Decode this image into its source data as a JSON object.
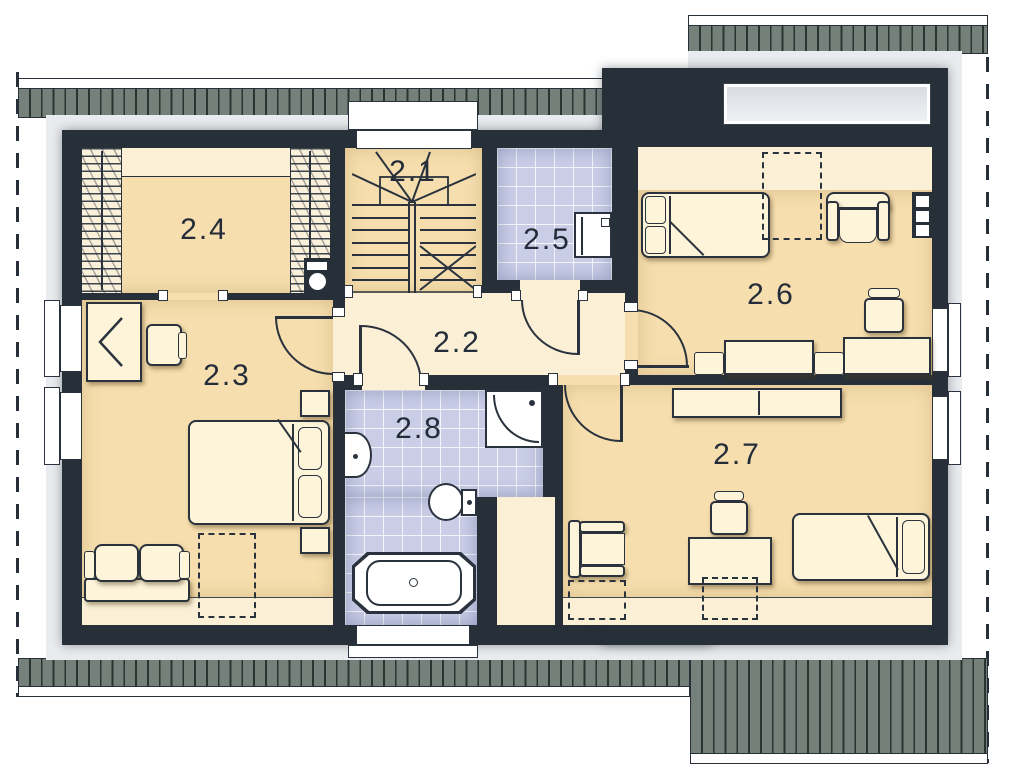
{
  "plan": {
    "kind": "architectural-floor-plan",
    "rooms": [
      {
        "label": "2.1",
        "type": "staircase"
      },
      {
        "label": "2.2",
        "type": "hallway"
      },
      {
        "label": "2.3",
        "type": "bedroom"
      },
      {
        "label": "2.4",
        "type": "walk-in-closet"
      },
      {
        "label": "2.5",
        "type": "laundry-wc"
      },
      {
        "label": "2.6",
        "type": "bedroom"
      },
      {
        "label": "2.7",
        "type": "bedroom"
      },
      {
        "label": "2.8",
        "type": "bathroom"
      }
    ],
    "fixtures": {
      "2.3": [
        "desk",
        "office-chair",
        "double-bed",
        "nightstand",
        "nightstand",
        "sofa",
        "skylight"
      ],
      "2.4": [
        "wardrobe",
        "wardrobe",
        "shelf-unit-with-basket"
      ],
      "2.5": [
        "washing-machine"
      ],
      "2.6": [
        "single-bed",
        "armchair",
        "wall-shelf",
        "office-chair",
        "desk",
        "sofa",
        "skylight",
        "roof-window"
      ],
      "2.7": [
        "sideboard",
        "armchair",
        "desk",
        "office-chair",
        "single-bed",
        "skylight",
        "skylight"
      ],
      "2.8": [
        "washbasin",
        "shower",
        "toilet",
        "bathtub"
      ]
    },
    "window_counts": {
      "left_wall": 2,
      "right_wall": 2,
      "stair_wall": 1,
      "bottom_wall": 1,
      "roof_windows": 1,
      "ceiling_skylights": 4
    },
    "colors": {
      "wall": "#273039",
      "floor_main": "#f6deae",
      "floor_light": "#fbf0d6",
      "bath_tiles": "#c9cde6",
      "roof_eaves": "#75807b",
      "outline": "#2a333d",
      "fixture_white": "#ffffff",
      "outside_margin": "#e9ebee"
    }
  }
}
